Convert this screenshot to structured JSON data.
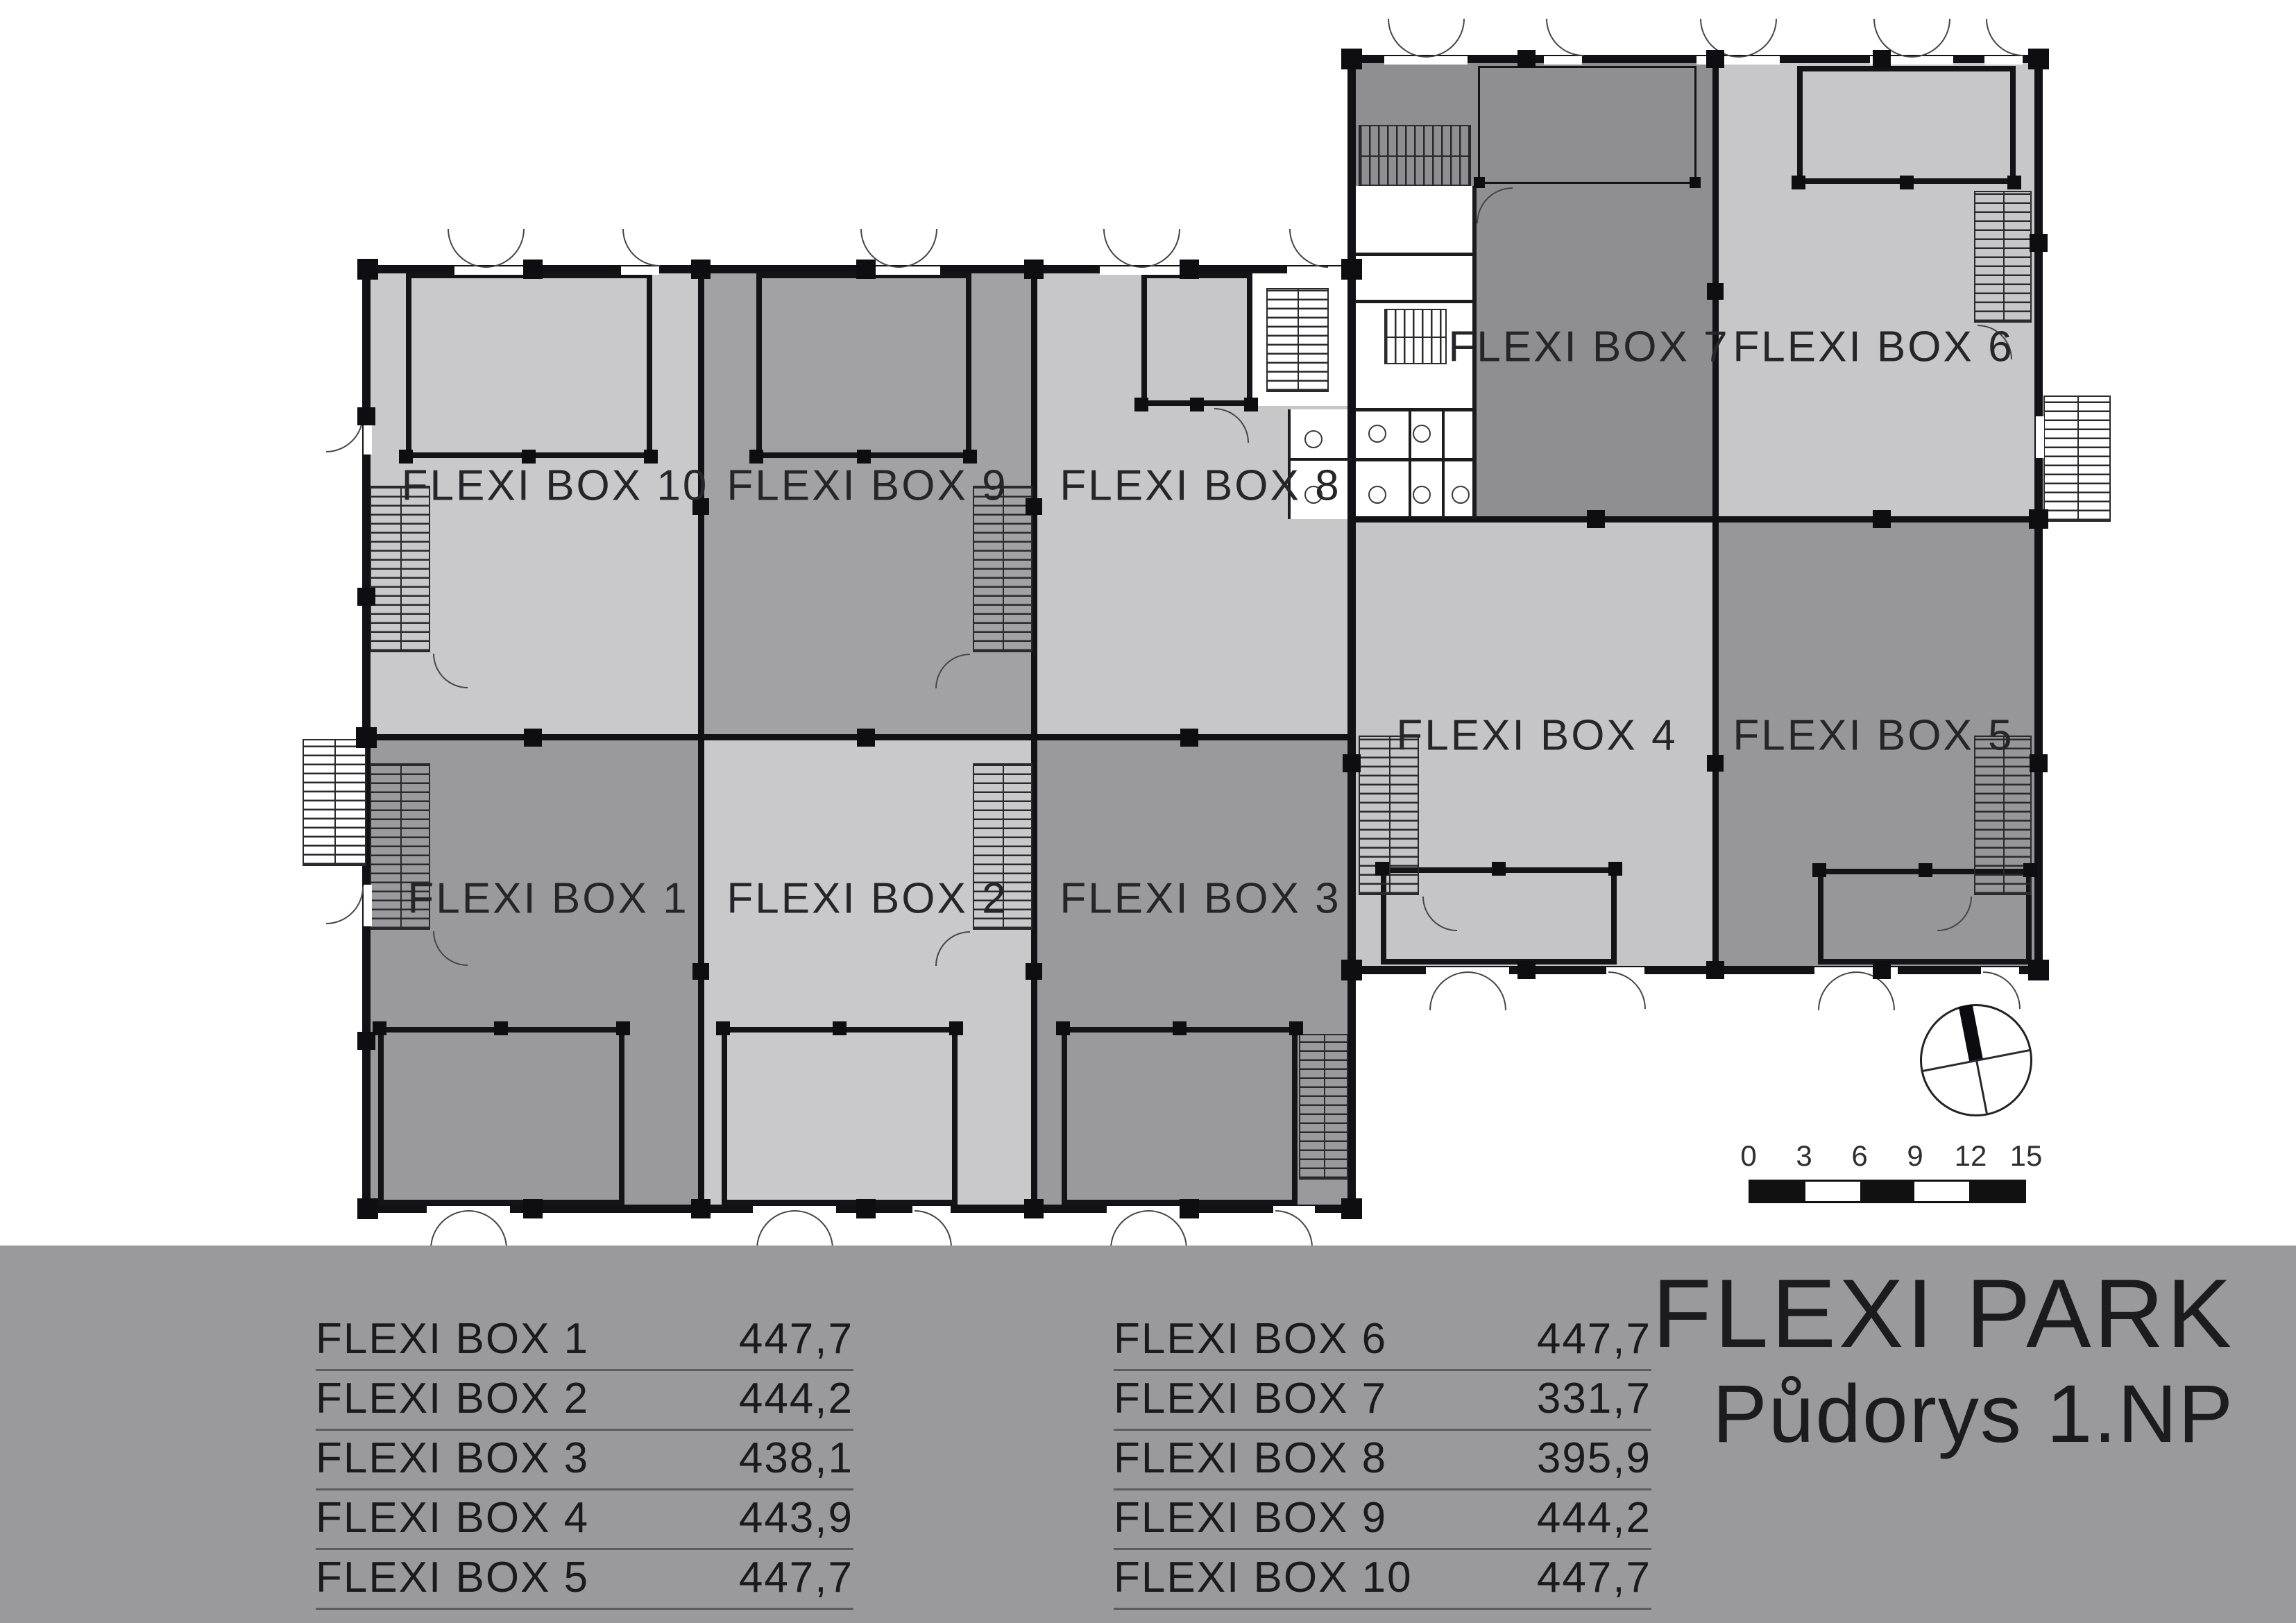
{
  "title": {
    "line1": "FLEXI PARK",
    "line2": "Půdorys 1.NP"
  },
  "legend": {
    "left": [
      {
        "name": "FLEXI BOX 1",
        "area": "447,7"
      },
      {
        "name": "FLEXI BOX 2",
        "area": "444,2"
      },
      {
        "name": "FLEXI BOX 3",
        "area": "438,1"
      },
      {
        "name": "FLEXI BOX 4",
        "area": "443,9"
      },
      {
        "name": "FLEXI BOX 5",
        "area": "447,7"
      }
    ],
    "right": [
      {
        "name": "FLEXI BOX 6",
        "area": "447,7"
      },
      {
        "name": "FLEXI BOX 7",
        "area": "331,7"
      },
      {
        "name": "FLEXI BOX 8",
        "area": "395,9"
      },
      {
        "name": "FLEXI BOX 9",
        "area": "444,2"
      },
      {
        "name": "FLEXI BOX 10",
        "area": "447,7"
      }
    ]
  },
  "scale_bar": {
    "labels": [
      "0",
      "3",
      "6",
      "9",
      "12",
      "15"
    ]
  },
  "floorplan": {
    "units": [
      {
        "id": 1,
        "label": "FLEXI BOX 1",
        "fill": "#9a9a9e"
      },
      {
        "id": 2,
        "label": "FLEXI BOX 2",
        "fill": "#c9c9cc"
      },
      {
        "id": 3,
        "label": "FLEXI BOX 3",
        "fill": "#9a9a9e"
      },
      {
        "id": 4,
        "label": "FLEXI BOX 4",
        "fill": "#c5c5c8"
      },
      {
        "id": 5,
        "label": "FLEXI BOX 5",
        "fill": "#97979b"
      },
      {
        "id": 6,
        "label": "FLEXI BOX 6",
        "fill": "#c7c7ca"
      },
      {
        "id": 7,
        "label": "FLEXI BOX 7",
        "fill": "#8e8e93"
      },
      {
        "id": 8,
        "label": "FLEXI BOX 8",
        "fill": "#c7c7ca"
      },
      {
        "id": 9,
        "label": "FLEXI BOX 9",
        "fill": "#a2a2a6"
      },
      {
        "id": 10,
        "label": "FLEXI BOX 10",
        "fill": "#c9c9cc"
      }
    ]
  },
  "colors": {
    "band": "#9a9a9e",
    "wall": "#121216",
    "underline": "#5c5c60",
    "text": "#1b1b1f"
  }
}
